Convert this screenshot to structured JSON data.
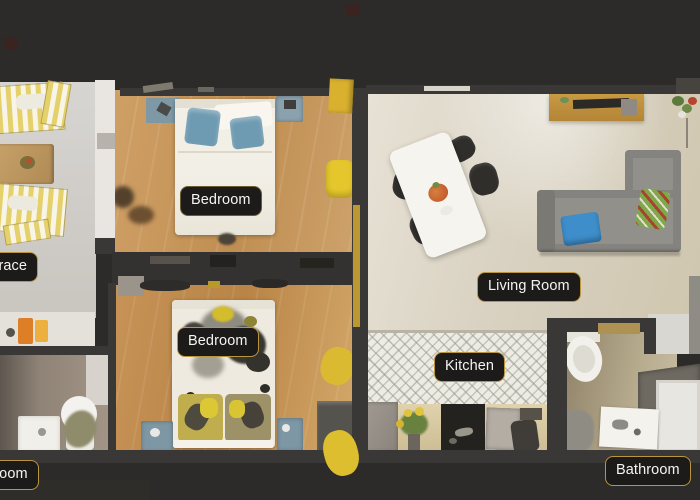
{
  "labels": {
    "terrace": "Terrace",
    "bedroom_top": "Bedroom",
    "bedroom_bottom": "Bedroom",
    "living_room": "Living Room",
    "kitchen": "Kitchen",
    "bathroom_left": "Bathroom",
    "bathroom_right": "Bathroom"
  },
  "colors": {
    "background": "#2c2b29",
    "label_background": "#1c1b19",
    "label_border": "#b9953f",
    "label_text": "#f5f4f2",
    "wall": "#3a3836",
    "wood_floor_bedroom1": "#c99c63",
    "wood_floor_bedroom2": "#c28d50",
    "terrace_floor": "#d2d0cd",
    "living_room_floor": "#ddd5c6",
    "kitchen_tile": "#edece4",
    "accent_yellow": "#dcbe2e",
    "pillow_blue": "#6f9bb2",
    "sofa_gray": "#8a8884"
  }
}
